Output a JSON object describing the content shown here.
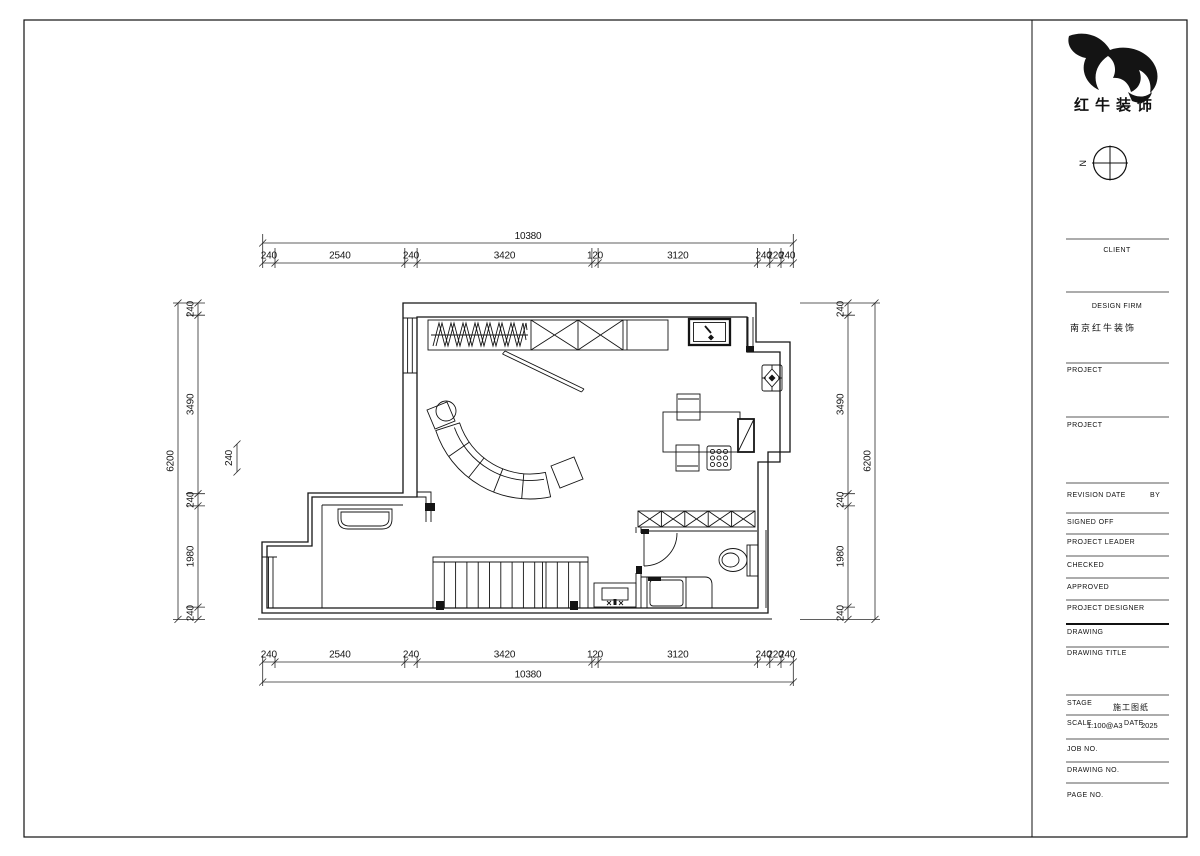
{
  "sheet": {
    "brand_name": "红牛装饰",
    "compass_label": "N",
    "client_label": "CLIENT",
    "design_firm_label": "DESIGN FIRM",
    "design_firm_value": "南京红牛装饰",
    "project_label": "PROJECT",
    "revision_label": "REVISION",
    "date_col_label": "DATE",
    "by_label": "BY",
    "signed_off_label": "SIGNED OFF",
    "project_leader_label": "PROJECT LEADER",
    "checked_label": "CHECKED",
    "approved_label": "APPROVED",
    "project_designer_label": "PROJECT DESIGNER",
    "drawing_label": "DRAWING",
    "drawing_title_label": "DRAWING TITLE",
    "stage_label": "STAGE",
    "stage_value": "施工图纸",
    "scale_label": "SCALE",
    "scale_value": "1:100@A3",
    "date_label": "DATE",
    "date_value": "2025",
    "job_no_label": "JOB NO.",
    "drawing_no_label": "DRAWING NO.",
    "page_no_label": "PAGE NO."
  },
  "dims": {
    "top": {
      "total": "10380",
      "segments": [
        "240",
        "2540",
        "240",
        "3420",
        "120",
        "3120",
        "240",
        "220",
        "240"
      ]
    },
    "bottom": {
      "total": "10380",
      "segments": [
        "240",
        "2540",
        "240",
        "3420",
        "120",
        "3120",
        "240",
        "220",
        "240"
      ]
    },
    "left": {
      "total": "6200",
      "segments": [
        "240",
        "3490",
        "240",
        "1980",
        "240"
      ],
      "floating": "240"
    },
    "right": {
      "total": "6200",
      "segments": [
        "240",
        "3490",
        "240",
        "1980",
        "240"
      ]
    }
  }
}
